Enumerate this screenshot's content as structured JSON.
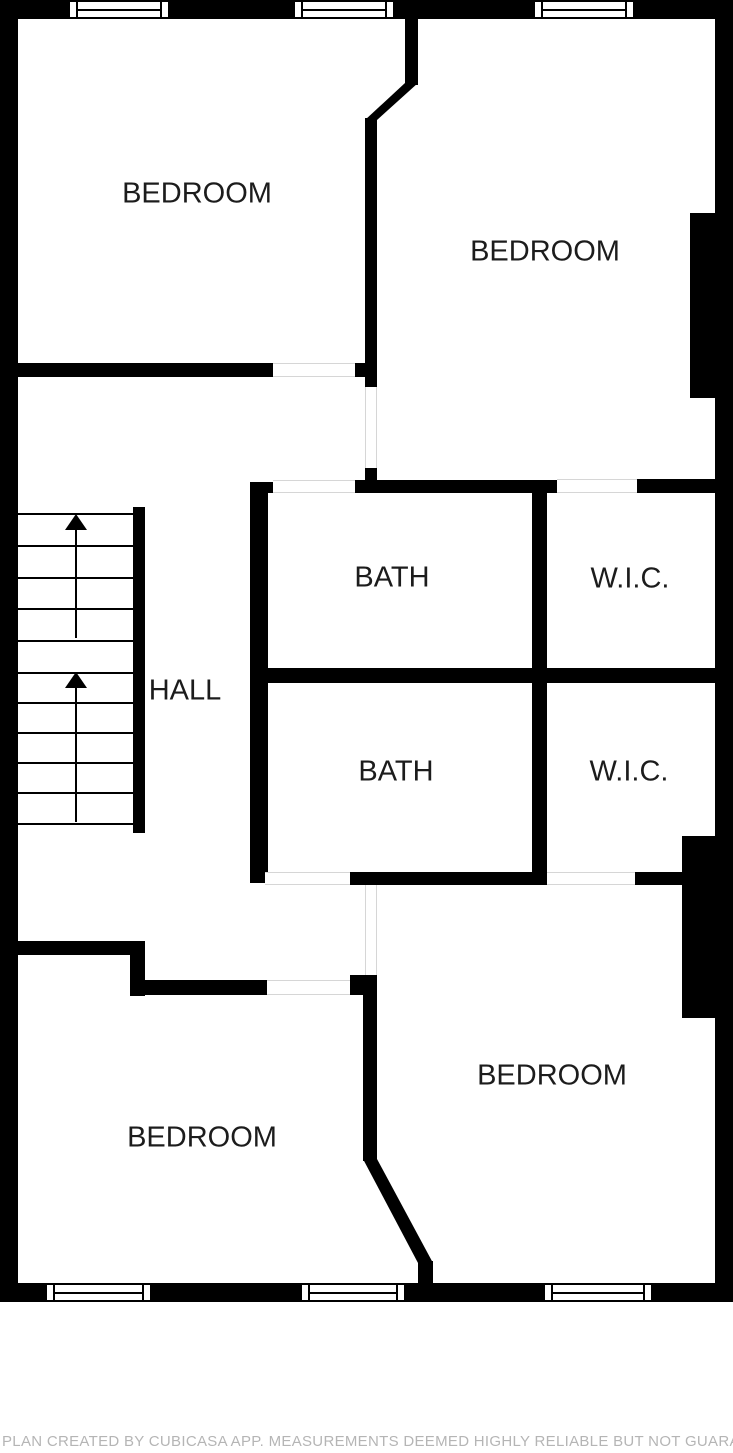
{
  "title": "Floor Plan",
  "disclaimer": "PLAN CREATED BY CUBICASA APP. MEASUREMENTS DEEMED HIGHLY RELIABLE BUT NOT GUARANTEED.",
  "colors": {
    "wall": "#000000",
    "background": "#ffffff",
    "label_text": "#1c1c1c",
    "opening_line": "#d6d6d6",
    "disclaimer_text": "#b5b5b5"
  },
  "rooms": [
    {
      "name": "room-label-bedroom-top-left",
      "label": "BEDROOM",
      "cx": 197,
      "cy": 194
    },
    {
      "name": "room-label-bedroom-top-right",
      "label": "BEDROOM",
      "cx": 545,
      "cy": 252
    },
    {
      "name": "room-label-bath-upper",
      "label": "BATH",
      "cx": 392,
      "cy": 578
    },
    {
      "name": "room-label-wic-upper",
      "label": "W.I.C.",
      "cx": 630,
      "cy": 579
    },
    {
      "name": "room-label-hall",
      "label": "HALL",
      "cx": 185,
      "cy": 691
    },
    {
      "name": "room-label-bath-lower",
      "label": "BATH",
      "cx": 396,
      "cy": 772
    },
    {
      "name": "room-label-wic-lower",
      "label": "W.I.C.",
      "cx": 629,
      "cy": 772
    },
    {
      "name": "room-label-bedroom-bottom-left",
      "label": "BEDROOM",
      "cx": 202,
      "cy": 1138
    },
    {
      "name": "room-label-bedroom-bottom-right",
      "label": "BEDROOM",
      "cx": 552,
      "cy": 1076
    }
  ],
  "plan": {
    "width": 733,
    "height": 1302,
    "walls": [
      {
        "x": 0,
        "y": 0,
        "w": 733,
        "h": 19
      },
      {
        "x": 0,
        "y": 0,
        "w": 18,
        "h": 1302
      },
      {
        "x": 715,
        "y": 0,
        "w": 18,
        "h": 1302
      },
      {
        "x": 0,
        "y": 1283,
        "w": 733,
        "h": 19
      },
      {
        "x": 690,
        "y": 213,
        "w": 25,
        "h": 185
      },
      {
        "x": 682,
        "y": 836,
        "w": 33,
        "h": 182
      },
      {
        "x": 18,
        "y": 363,
        "w": 255,
        "h": 14
      },
      {
        "x": 355,
        "y": 363,
        "w": 22,
        "h": 14
      },
      {
        "x": 405,
        "y": 19,
        "w": 13,
        "h": 66
      },
      {
        "x": 365,
        "y": 118,
        "w": 12,
        "h": 270
      },
      {
        "x": 365,
        "y": 467,
        "w": 12,
        "h": 16
      },
      {
        "x": 355,
        "y": 480,
        "w": 202,
        "h": 13
      },
      {
        "x": 637,
        "y": 479,
        "w": 78,
        "h": 14
      },
      {
        "x": 250,
        "y": 482,
        "w": 23,
        "h": 11
      },
      {
        "x": 250,
        "y": 482,
        "w": 18,
        "h": 401
      },
      {
        "x": 532,
        "y": 480,
        "w": 15,
        "h": 405
      },
      {
        "x": 250,
        "y": 668,
        "w": 483,
        "h": 15
      },
      {
        "x": 350,
        "y": 872,
        "w": 200,
        "h": 13
      },
      {
        "x": 635,
        "y": 872,
        "w": 48,
        "h": 13
      },
      {
        "x": 0,
        "y": 941,
        "w": 145,
        "h": 14
      },
      {
        "x": 130,
        "y": 955,
        "w": 15,
        "h": 41
      },
      {
        "x": 130,
        "y": 980,
        "w": 137,
        "h": 15
      },
      {
        "x": 350,
        "y": 975,
        "w": 27,
        "h": 20
      },
      {
        "x": 363,
        "y": 993,
        "w": 14,
        "h": 168
      },
      {
        "x": 418,
        "y": 1261,
        "w": 15,
        "h": 24
      },
      {
        "x": 133,
        "y": 507,
        "w": 12,
        "h": 326
      }
    ],
    "diagonal_walls": [
      {
        "x": 365,
        "y": 83,
        "w": 53,
        "h": 37,
        "poly": "polygon(40px 0px, 53px 0px, 12px 37px, 0px 37px)"
      },
      {
        "x": 363,
        "y": 1159,
        "w": 70,
        "h": 104,
        "poly": "polygon(0px 0px, 14px 0px, 70px 104px, 55px 104px)"
      }
    ],
    "windows": [
      {
        "x": 68,
        "y": 0,
        "w": 102,
        "h": 19
      },
      {
        "x": 293,
        "y": 0,
        "w": 102,
        "h": 19
      },
      {
        "x": 533,
        "y": 0,
        "w": 102,
        "h": 19
      },
      {
        "x": 45,
        "y": 1283,
        "w": 107,
        "h": 19
      },
      {
        "x": 300,
        "y": 1283,
        "w": 106,
        "h": 19
      },
      {
        "x": 543,
        "y": 1283,
        "w": 110,
        "h": 19
      }
    ],
    "openings_horizontal": [
      {
        "x": 273,
        "y": 363,
        "w": 82,
        "h": 14
      },
      {
        "x": 273,
        "y": 480,
        "w": 82,
        "h": 13
      },
      {
        "x": 557,
        "y": 479,
        "w": 80,
        "h": 14
      },
      {
        "x": 265,
        "y": 872,
        "w": 85,
        "h": 13
      },
      {
        "x": 547,
        "y": 872,
        "w": 88,
        "h": 13
      },
      {
        "x": 267,
        "y": 980,
        "w": 83,
        "h": 15
      }
    ],
    "openings_vertical": [
      {
        "x": 365,
        "y": 387,
        "w": 12,
        "h": 81
      },
      {
        "x": 365,
        "y": 885,
        "w": 12,
        "h": 90
      }
    ],
    "stairs": {
      "x": 18,
      "y": 513,
      "w": 115,
      "h": 320,
      "tread_y": [
        513,
        545,
        577,
        608,
        640,
        672,
        702,
        732,
        762,
        792,
        823
      ],
      "center_x": 76,
      "runs": [
        {
          "arrow_tip_y": 514,
          "line_y1": 528,
          "line_y2": 638
        },
        {
          "arrow_tip_y": 672,
          "line_y1": 686,
          "line_y2": 822
        }
      ]
    }
  }
}
